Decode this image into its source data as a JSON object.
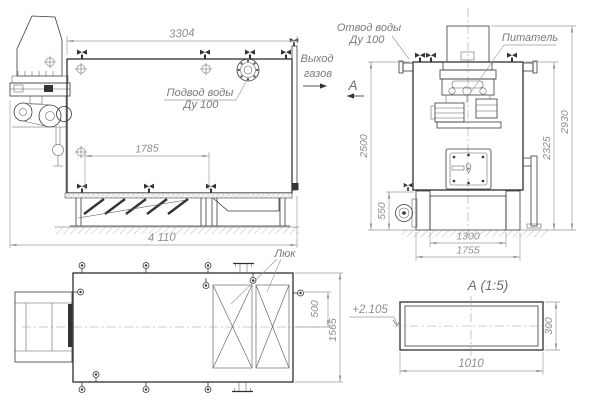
{
  "palette": {
    "outline": "#2e2e2e",
    "thin_line": "#5a5a5a",
    "dimension_line": "#9b9b9b",
    "dimension_text": "#8f8f8f",
    "label_text": "#7a7a7a",
    "background": "#ffffff"
  },
  "front_view": {
    "dim_top_width": "3304",
    "dim_grate_length": "1785",
    "dim_overall_length": "4 110",
    "water_supply_line1": "Подвод воды",
    "water_supply_line2": "Ду 100",
    "gas_outlet_line1": "Выход",
    "gas_outlet_line2": "газов",
    "section_mark": "А"
  },
  "side_view": {
    "water_return_line1": "Отвод воды",
    "water_return_line2": "Ду 100",
    "feeder_label": "Питатель",
    "dim_left_height": "2500",
    "dim_base_height": "550",
    "dim_base_inner": "1300",
    "dim_base_outer": "1755",
    "dim_right_inner_height": "2325",
    "dim_overall_height": "2930"
  },
  "plan_view": {
    "hatch_label": "Люк",
    "dim_nozzle_offset": "500",
    "dim_overall_width": "1565"
  },
  "section_view": {
    "title": "А  (1:5)",
    "dim_length": "1010",
    "dim_height": "300",
    "elevation_mark": "+2.105"
  }
}
